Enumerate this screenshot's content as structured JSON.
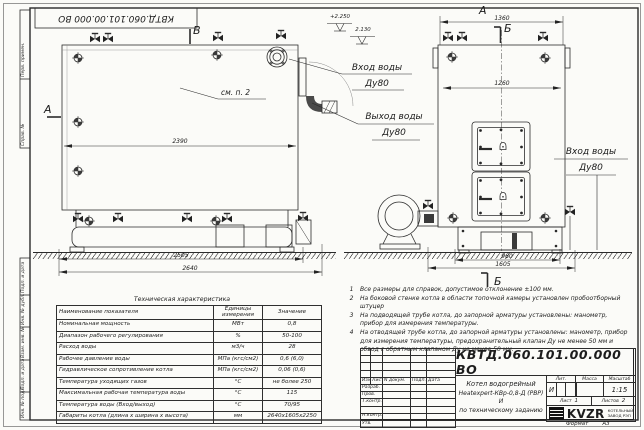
{
  "stamp_top": "КВТД.060.101.00.000 ВО",
  "margin": {
    "labels": [
      "Перв. примен.",
      "Справ. №",
      "Подп. и дата",
      "Инв. № дубл.",
      "Взам. инв. №",
      "Подп. и дата",
      "Инв. № подл."
    ]
  },
  "side_view": {
    "section_b": "В",
    "section_a": "А",
    "see_note": "см. п. 2",
    "dim_inner": "2390",
    "dim_base": "2505",
    "dim_overall": "2640",
    "elevation_top": "+2.250",
    "elevation_mid": "2.130",
    "inlet_line1": "Вход воды",
    "inlet_line2": "Ду80",
    "outlet_line1": "Выход воды",
    "outlet_line2": "Ду80"
  },
  "front_view": {
    "view_a": "А",
    "dim_top": "1360",
    "section_b": "Б",
    "dim_inner": "1260",
    "dim_base": "960",
    "dim_overall": "1605",
    "view_b": "Б",
    "inlet_line1": "Вход воды",
    "inlet_line2": "Ду80"
  },
  "notes": [
    {
      "num": "1",
      "text": "Все размеры для справок, допустимое отклонение ±100 мм."
    },
    {
      "num": "2",
      "text": "На боковой стенке котла в области топочной камеры установлен пробоотборный штуцер"
    },
    {
      "num": "3",
      "text": "На подводящей трубе котла, до запорной арматуры установлены: манометр, прибор для измерения температуры."
    },
    {
      "num": "4",
      "text": "На отводящей трубе котла, до запорной арматуры установлены: манометр, прибор для измерения температуры, предохранительный клапан Ду не менее 50 мм и обвод с обратным клапаном Ду не менее 50 мм."
    }
  ],
  "tech_table": {
    "title": "Техническая характеристика",
    "headers": {
      "name": "Наименование показателя",
      "unit": "Единицы измерения",
      "value": "Значение"
    },
    "rows": [
      {
        "name": "Номинальная мощность",
        "unit": "МВт",
        "value": "0,8"
      },
      {
        "name": "Диапазон рабочего регулирования",
        "unit": "%",
        "value": "50-100"
      },
      {
        "name": "Расход воды",
        "unit": "м3/ч",
        "value": "28"
      },
      {
        "name": "Рабочее давление воды",
        "unit": "МПа (кгс/см2)",
        "value": "0,6 (6,0)"
      },
      {
        "name": "Гидравлическое сопротивление котла",
        "unit": "МПа (кгс/см2)",
        "value": "0,06 (0,6)"
      },
      {
        "name": "Температура уходящих газов",
        "unit": "°С",
        "value": "не более 250"
      },
      {
        "name": "Максимальная рабочая температура воды",
        "unit": "°С",
        "value": "115"
      },
      {
        "name": "Температура воды (Вход/выход)",
        "unit": "°С",
        "value": "70/95"
      },
      {
        "name": "Габариты котла (длина х ширина х высота)",
        "unit": "мм",
        "value": "2640х1605х2250"
      }
    ]
  },
  "title_block": {
    "doc_number": "КВТД.060.101.00.000 ВО",
    "product_line1": "Котел водогрейный",
    "product_line2": "Heatexpert-КВр-0,8-Д (РВР) И",
    "product_line3": "по техническому заданию",
    "col_izm": "Изм.",
    "col_list": "Лист",
    "col_docnum": "N докум.",
    "col_podp": "Подп.",
    "col_data": "Дата",
    "row_razrab": "Разраб.",
    "row_prov": "Пров.",
    "row_tkontr": "Т.контр.",
    "row_nkontr": "Н.контр.",
    "row_utv": "Утв.",
    "lit_header": "Лит.",
    "mass_header": "Масса",
    "scale_header": "Масштаб",
    "lit_value": "И",
    "scale_value": "1:15",
    "sheet_label": "Лист",
    "sheet_value": "1",
    "sheets_label": "Листов",
    "sheets_value": "2",
    "logo_text": "KVZR",
    "logo_sub1": "КОТЕЛЬНЫЙ",
    "logo_sub2": "ЗАВОД РЭП",
    "format_label": "Формат",
    "format_value": "А3"
  }
}
